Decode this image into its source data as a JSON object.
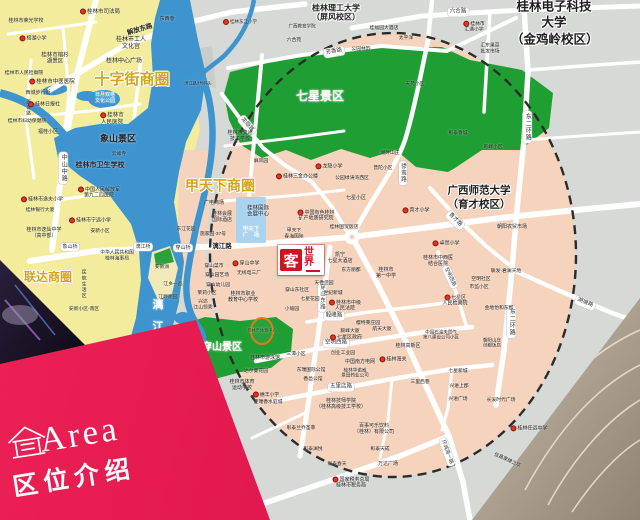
{
  "banner": {
    "en": "Area",
    "zh": "区位介绍"
  },
  "logo": {
    "main": "客",
    "rest": "世界",
    "name": "客世界"
  },
  "colors": {
    "banner_red": "#e3174e",
    "logo_red": "#cf1322",
    "park_green": "#1f9e33",
    "water_blue": "#3d94cf",
    "zone_pink": "#f6d3bc",
    "west_yellow": "#f2ec9c",
    "outside_gray": "#d6d9d5",
    "district_gold": "#d5a41f"
  },
  "map": {
    "labels": [
      {
        "id": "district-shizijie",
        "t": "十字街商圈",
        "x": 132,
        "y": 80,
        "s": 15,
        "b": 1,
        "c": "#d5a41f",
        "halo": 1
      },
      {
        "id": "district-jiatianxia",
        "t": "甲天下商圈",
        "x": 220,
        "y": 186,
        "s": 14,
        "b": 1,
        "c": "#d5a41f",
        "halo": 1
      },
      {
        "id": "district-lianda",
        "t": "联达商圈",
        "x": 48,
        "y": 277,
        "s": 12,
        "b": 1,
        "c": "#d5a41f",
        "halo": 1
      },
      {
        "id": "park-qixing",
        "t": "七星景区",
        "x": 320,
        "y": 96,
        "s": 12,
        "b": 1,
        "c": "#ffffff"
      },
      {
        "id": "park-chuanshan",
        "t": "穿山景区",
        "x": 222,
        "y": 348,
        "s": 10,
        "b": 1,
        "c": "#ffffff"
      },
      {
        "id": "park-xiangshan",
        "t": "象山景区",
        "x": 118,
        "y": 139,
        "s": 9,
        "b": 1
      },
      {
        "id": "univ-guet",
        "t": "桂林电子科技大学\n（金鸡岭校区）",
        "x": 554,
        "y": 23,
        "s": 12.5,
        "b": 1,
        "halo": 1,
        "lh": 1.3
      },
      {
        "id": "univ-glut",
        "t": "桂林理工大学\n（屏风校区）",
        "x": 336,
        "y": 13,
        "s": 8,
        "b": 1,
        "halo": 1
      },
      {
        "id": "univ-gxnu",
        "t": "广西师范大学\n（育才校区）",
        "x": 479,
        "y": 198,
        "s": 10.5,
        "b": 1,
        "halo": 1,
        "lh": 1.3
      },
      {
        "id": "river-lijiang",
        "t": "漓\n江",
        "x": 158,
        "y": 316,
        "s": 11,
        "b": 1,
        "c": "#ffffff",
        "lh": 2.0
      },
      {
        "t": "解放东路",
        "x": 140,
        "y": 30,
        "s": 6.5,
        "b": 1,
        "r": -17
      },
      {
        "t": "中山中路",
        "x": 63,
        "y": 168,
        "s": 6,
        "v": 1,
        "pill": 1
      },
      {
        "t": "西城路",
        "x": 28,
        "y": 108,
        "s": 4.5,
        "v": 1
      },
      {
        "t": "漓江路",
        "x": 222,
        "y": 247,
        "s": 6.5,
        "b": 1
      },
      {
        "t": "象山桥",
        "x": 70,
        "y": 247,
        "s": 5,
        "pill": 1
      },
      {
        "t": "漓江桥",
        "x": 143,
        "y": 247,
        "s": 5,
        "pill": 1
      },
      {
        "t": "穿山桥",
        "x": 183,
        "y": 248,
        "s": 5,
        "pill": 1
      },
      {
        "t": "六合路",
        "x": 458,
        "y": 12,
        "s": 5.5,
        "pill": 1
      },
      {
        "t": "芳香路",
        "x": 334,
        "y": 52,
        "s": 5.5,
        "r": -10,
        "pill": 1
      },
      {
        "t": "龙隐路",
        "x": 247,
        "y": 125,
        "s": 5.5,
        "r": 50,
        "pill": 1
      },
      {
        "t": "东二环路",
        "x": 527,
        "y": 127,
        "s": 6,
        "v": 1,
        "pill": 1
      },
      {
        "t": "东二环路",
        "x": 511,
        "y": 322,
        "s": 6,
        "v": 1,
        "pill": 1
      },
      {
        "t": "骖鸾路",
        "x": 403,
        "y": 173,
        "s": 5.5,
        "v": 1,
        "pill": 1
      },
      {
        "t": "育才路",
        "x": 455,
        "y": 220,
        "s": 5.5,
        "r": 45,
        "pill": 1
      },
      {
        "t": "湖塘路",
        "x": 585,
        "y": 303,
        "s": 5.5,
        "r": 22,
        "pill": 1
      },
      {
        "t": "穿山东路",
        "x": 322,
        "y": 297,
        "s": 5.5,
        "v": 1,
        "pill": 1
      },
      {
        "t": "毅峰路",
        "x": 334,
        "y": 316,
        "s": 5.5,
        "pill": 1
      },
      {
        "t": "空明西路",
        "x": 336,
        "y": 343,
        "s": 5.5,
        "pill": 1
      },
      {
        "t": "空明西路",
        "x": 450,
        "y": 277,
        "s": 5,
        "r": 65,
        "pill": 1
      },
      {
        "t": "五里店路",
        "x": 341,
        "y": 387,
        "s": 5.5,
        "pill": 1
      },
      {
        "t": "环城南一路",
        "x": 447,
        "y": 452,
        "s": 5,
        "r": 70,
        "pill": 1
      },
      {
        "t": "桂林市司法局",
        "x": 100,
        "y": 12,
        "s": 5.5,
        "dot": 1
      },
      {
        "t": "桂林市荣光学校",
        "x": 26,
        "y": 22,
        "s": 5
      },
      {
        "t": "东西巷",
        "x": 167,
        "y": 20,
        "s": 5
      },
      {
        "t": "榕湖小学",
        "x": 33,
        "y": 39,
        "s": 5,
        "dot": 1
      },
      {
        "t": "桂林市工人\n文化宫",
        "x": 131,
        "y": 44,
        "s": 6
      },
      {
        "t": "桂林市榕杉\n湖景区",
        "x": 55,
        "y": 59,
        "s": 5.5
      },
      {
        "t": "桂林中心广场",
        "x": 124,
        "y": 62,
        "s": 6
      },
      {
        "t": "桂林市中医医院",
        "x": 52,
        "y": 82,
        "s": 5.5,
        "dot": 1
      },
      {
        "t": "西城步行街",
        "x": 38,
        "y": 94,
        "s": 5
      },
      {
        "t": "桂林市人民检察院",
        "x": 24,
        "y": 74,
        "s": 4.8
      },
      {
        "t": "桂林日报社",
        "x": 44,
        "y": 105,
        "s": 5,
        "dot": 1
      },
      {
        "t": "桂林市妇幼保健院",
        "x": 27,
        "y": 122,
        "s": 4.8
      },
      {
        "t": "福桂小区",
        "x": 48,
        "y": 133,
        "s": 5
      },
      {
        "t": "桂林市\n人民医院",
        "x": 112,
        "y": 119,
        "s": 5.5,
        "dot": 1
      },
      {
        "t": "日月双塔\n文化公园",
        "x": 105,
        "y": 99,
        "s": 5,
        "c": "#ffffff"
      },
      {
        "t": "云峰寺",
        "x": 119,
        "y": 155,
        "s": 4.8
      },
      {
        "t": "桂林市卫生学校",
        "x": 100,
        "y": 166,
        "s": 7,
        "b": 1
      },
      {
        "t": "滨江路3号码头",
        "x": 198,
        "y": 84,
        "s": 4.2
      },
      {
        "t": "桂林市逸夫小学",
        "x": 42,
        "y": 200,
        "s": 5,
        "dot": 1
      },
      {
        "t": "桂林银行大厦",
        "x": 40,
        "y": 211,
        "s": 4.8
      },
      {
        "t": "桂林市逸仙中学\n（高中部）",
        "x": 44,
        "y": 234,
        "s": 5
      },
      {
        "t": "中国人民解放军\n第九二四医院",
        "x": 99,
        "y": 193,
        "s": 5,
        "dot": 1
      },
      {
        "t": "桂林市宁远小学",
        "x": 90,
        "y": 221,
        "s": 5,
        "dot": 1
      },
      {
        "t": "安新小区",
        "x": 100,
        "y": 232,
        "s": 4.8
      },
      {
        "t": "东江花园",
        "x": 186,
        "y": 230,
        "s": 4.8
      },
      {
        "t": "施家园-37号",
        "x": 213,
        "y": 235,
        "s": 4.8
      },
      {
        "t": "中华人民共和国\n桂林海事局",
        "x": 117,
        "y": 256,
        "s": 4.8
      },
      {
        "t": "安新洲",
        "x": 162,
        "y": 268,
        "s": 4.8
      },
      {
        "t": "民航生活区",
        "x": 83,
        "y": 284,
        "s": 4.8,
        "v": 1
      },
      {
        "t": "江乡一品",
        "x": 173,
        "y": 285,
        "s": 4.8
      },
      {
        "t": "江畔丽园",
        "x": 168,
        "y": 298,
        "s": 4.8
      },
      {
        "t": "安新小区-南区",
        "x": 84,
        "y": 310,
        "s": 4.8
      },
      {
        "t": "广电商场",
        "x": 214,
        "y": 204,
        "s": 5
      },
      {
        "t": "桂林会展\n国际酒店",
        "x": 222,
        "y": 218,
        "s": 5
      },
      {
        "t": "桂林国际\n会展中心",
        "x": 258,
        "y": 212,
        "s": 5.5
      },
      {
        "t": "甲天下\n广　场",
        "x": 251,
        "y": 233,
        "s": 5.5,
        "c": "#ffffff"
      },
      {
        "t": "中国有色桂林\n矿产地质研究院",
        "x": 316,
        "y": 216,
        "s": 5,
        "dot": 1
      },
      {
        "t": "甲天下\n春海国际",
        "x": 294,
        "y": 234,
        "s": 4.8
      },
      {
        "t": "桂林国贸饭店",
        "x": 344,
        "y": 228,
        "s": 4.8
      },
      {
        "t": "七星小区",
        "x": 356,
        "y": 199,
        "s": 5
      },
      {
        "t": "桂林三金办公楼",
        "x": 297,
        "y": 177,
        "s": 5,
        "dot": 1
      },
      {
        "t": "公园绿涛湾西区",
        "x": 352,
        "y": 179,
        "s": 4.8
      },
      {
        "t": "彰泰香城",
        "x": 458,
        "y": 134,
        "s": 4.8
      },
      {
        "t": "奇峰小区",
        "x": 493,
        "y": 148,
        "s": 4.8
      },
      {
        "t": "湖畔山庄",
        "x": 390,
        "y": 154,
        "s": 4.8
      },
      {
        "t": "普陀小区",
        "x": 383,
        "y": 169,
        "s": 4.8
      },
      {
        "t": "育才小学",
        "x": 416,
        "y": 211,
        "s": 5,
        "dot": 1
      },
      {
        "t": "朝阳农贸市场",
        "x": 512,
        "y": 228,
        "s": 5
      },
      {
        "t": "卓然小学",
        "x": 446,
        "y": 244,
        "s": 5,
        "dot": 1
      },
      {
        "t": "桂林市中西医\n结合医院",
        "x": 438,
        "y": 262,
        "s": 5
      },
      {
        "t": "空明社区",
        "x": 481,
        "y": 280,
        "s": 4.8
      },
      {
        "t": "市监小区",
        "x": 479,
        "y": 288,
        "s": 4.8
      },
      {
        "t": "七星区\n人民检察院",
        "x": 455,
        "y": 301,
        "s": 5,
        "dot": 1
      },
      {
        "t": "联发·君澜天地",
        "x": 506,
        "y": 272,
        "s": 4.8
      },
      {
        "t": "金地怡和东郡",
        "x": 499,
        "y": 309,
        "s": 4.8
      },
      {
        "t": "中国石油天然气\n第八建设公司小区",
        "x": 441,
        "y": 335,
        "s": 4.5
      },
      {
        "t": "凯宁\n七星大酒店",
        "x": 340,
        "y": 259,
        "s": 5
      },
      {
        "t": "东方丽都",
        "x": 351,
        "y": 271,
        "s": 4.8
      },
      {
        "t": "天香佳园",
        "x": 324,
        "y": 284,
        "s": 4.8
      },
      {
        "t": "世纪新城",
        "x": 333,
        "y": 294,
        "s": 4.8
      },
      {
        "t": "桂林市中级\n人民法院",
        "x": 345,
        "y": 306,
        "s": 5,
        "dot": 1
      },
      {
        "t": "穿山东社区",
        "x": 297,
        "y": 291,
        "s": 4.8
      },
      {
        "t": "七星花园",
        "x": 310,
        "y": 300,
        "s": 4.8
      },
      {
        "t": "小喻园",
        "x": 292,
        "y": 310,
        "s": 4.8
      },
      {
        "t": "桂林市\n第一中学",
        "x": 386,
        "y": 274,
        "s": 5
      },
      {
        "t": "樱特莱庄园",
        "x": 368,
        "y": 324,
        "s": 4.8
      },
      {
        "t": "毅峰大厦",
        "x": 350,
        "y": 332,
        "s": 4.8
      },
      {
        "t": "航天大厦",
        "x": 382,
        "y": 330,
        "s": 4.8
      },
      {
        "t": "七星区政府",
        "x": 346,
        "y": 338,
        "s": 5,
        "dot": 1
      },
      {
        "t": "穿山菜市",
        "x": 214,
        "y": 267,
        "s": 4.8
      },
      {
        "t": "穿山中学",
        "x": 246,
        "y": 264,
        "s": 5,
        "dot": 1
      },
      {
        "t": "穿山园艺场",
        "x": 217,
        "y": 276,
        "s": 4.8
      },
      {
        "t": "穿山幼儿园",
        "x": 218,
        "y": 286,
        "s": 4.8
      },
      {
        "t": "无线电三厂",
        "x": 249,
        "y": 274,
        "s": 4.8
      },
      {
        "t": "茉莉小区",
        "x": 207,
        "y": 294,
        "s": 4.8
      },
      {
        "t": "兴达\n江山领秀",
        "x": 203,
        "y": 305,
        "s": 4.8
      },
      {
        "t": "桂林市职业\n教育中心学校",
        "x": 243,
        "y": 298,
        "s": 5
      },
      {
        "t": "桂林市体育中心",
        "x": 262,
        "y": 331,
        "s": 4.2,
        "c": "#123a12"
      },
      {
        "t": "桂林市游泳馆",
        "x": 265,
        "y": 359,
        "s": 5
      },
      {
        "t": "达尔曼花园",
        "x": 256,
        "y": 372,
        "s": 4.8
      },
      {
        "t": "桂林市体育\n运动学校",
        "x": 242,
        "y": 386,
        "s": 5
      },
      {
        "t": "穗丰小学",
        "x": 266,
        "y": 395,
        "s": 4.8,
        "dot": 1
      },
      {
        "t": "佳瑞香水庭城",
        "x": 268,
        "y": 403,
        "s": 4.8
      },
      {
        "t": "三潭小区",
        "x": 296,
        "y": 355,
        "s": 4.8
      },
      {
        "t": "创业工业园",
        "x": 343,
        "y": 354,
        "s": 4.8
      },
      {
        "t": "中国南方电网",
        "x": 360,
        "y": 363,
        "s": 5
      },
      {
        "t": "桂林海关",
        "x": 393,
        "y": 360,
        "s": 5,
        "dot": 1
      },
      {
        "t": "桂林高新区",
        "x": 408,
        "y": 347,
        "s": 5
      },
      {
        "t": "桂林华诺威\n景田药业公司",
        "x": 355,
        "y": 373,
        "s": 4.6
      },
      {
        "t": "东瑞国际公馆",
        "x": 311,
        "y": 371,
        "s": 4.8
      },
      {
        "t": "香邑公馆",
        "x": 313,
        "y": 380,
        "s": 4.8
      },
      {
        "t": "桂林技师学院\n（桂林高级技工学校）",
        "x": 341,
        "y": 405,
        "s": 5
      },
      {
        "t": "三里西巷",
        "x": 420,
        "y": 383,
        "s": 4.8
      },
      {
        "t": "彰泰兰乔圣菲",
        "x": 301,
        "y": 429,
        "s": 4.8
      },
      {
        "t": "百事可乐饮料\n（桂林）有限公司",
        "x": 374,
        "y": 430,
        "s": 5
      },
      {
        "t": "彰泰澜悦",
        "x": 313,
        "y": 450,
        "s": 4.8
      },
      {
        "t": "彰泰天成",
        "x": 380,
        "y": 450,
        "s": 4.8
      },
      {
        "t": "彰泰春天",
        "x": 337,
        "y": 465,
        "s": 4.8
      },
      {
        "t": "万达广场",
        "x": 388,
        "y": 465,
        "s": 5
      },
      {
        "t": "国家税务总局\n桂林市税务局",
        "x": 351,
        "y": 483,
        "s": 5,
        "dot": 1
      },
      {
        "t": "七星新城",
        "x": 458,
        "y": 372,
        "s": 4.8
      },
      {
        "t": "兴进上郡",
        "x": 459,
        "y": 387,
        "s": 4.8
      },
      {
        "t": "兴进广场",
        "x": 458,
        "y": 400,
        "s": 4.8
      },
      {
        "t": "朝阳山庄\n创都饭店",
        "x": 492,
        "y": 343,
        "s": 4.5
      },
      {
        "t": "长溪时代广场",
        "x": 501,
        "y": 401,
        "s": 4.8
      },
      {
        "t": "桂林任远中学",
        "x": 529,
        "y": 429,
        "s": 5,
        "dot": 1
      },
      {
        "t": "信昌棠棣之华",
        "x": 507,
        "y": 461,
        "s": 4.8,
        "r": 25
      },
      {
        "t": "公园林韵",
        "x": 361,
        "y": 50,
        "s": 4.8
      },
      {
        "t": "桂福园大酒店",
        "x": 384,
        "y": 29,
        "s": 4.8
      },
      {
        "t": "太平洋",
        "x": 406,
        "y": 39,
        "s": 4.8
      },
      {
        "t": "六合苑",
        "x": 294,
        "y": 41,
        "s": 4.8
      },
      {
        "t": "天苑小区",
        "x": 415,
        "y": 85,
        "s": 4.8
      },
      {
        "t": "屏风园",
        "x": 261,
        "y": 162,
        "s": 4.8
      },
      {
        "t": "龙隐小学",
        "x": 329,
        "y": 167,
        "s": 5,
        "dot": 1
      },
      {
        "t": "桂林市交通\n技工学校",
        "x": 240,
        "y": 137,
        "s": 5
      },
      {
        "t": "桂林市\n汇通小学",
        "x": 474,
        "y": 27,
        "s": 4.8,
        "dot": 1
      },
      {
        "t": "汇东果菜\n批发市场",
        "x": 490,
        "y": 49,
        "s": 4.8
      },
      {
        "t": "广西教育学院",
        "x": 302,
        "y": 26,
        "s": 4.5
      },
      {
        "t": "桂林东江小学",
        "x": 240,
        "y": 22,
        "s": 4.5,
        "dot": 1
      }
    ]
  }
}
